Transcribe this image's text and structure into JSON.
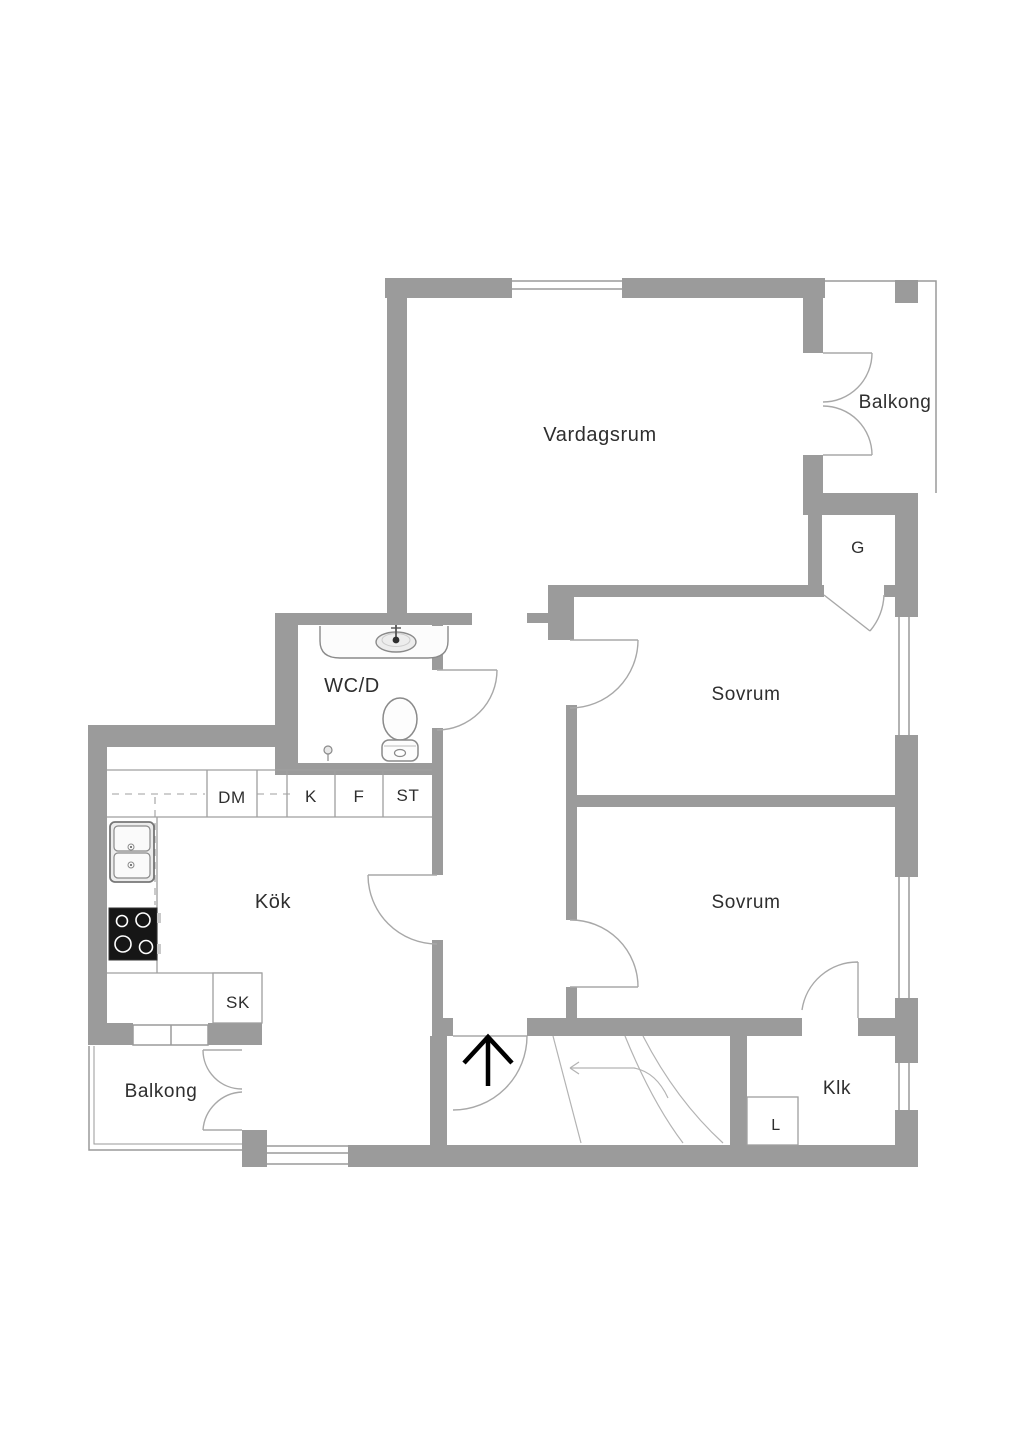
{
  "plan": {
    "rooms": {
      "living_room": "Vardagsrum",
      "balcony_top": "Balkong",
      "closet_g": "G",
      "bedroom_1": "Sovrum",
      "bathroom": "WC/D",
      "kitchen": "Kök",
      "bedroom_2": "Sovrum",
      "closet_sk": "SK",
      "balcony_bottom": "Balkong",
      "walk_in_closet": "Klk",
      "closet_l": "L"
    },
    "kitchen_units": {
      "dm": "DM",
      "k": "K",
      "f": "F",
      "st": "ST"
    },
    "colors": {
      "background": "#ffffff",
      "wall": "#9b9b9b",
      "window_line": "#9a9a9a",
      "door_line": "#a8a8a8",
      "counter_line": "#9f9f9f",
      "stair_line": "#b3b3b3",
      "fixture_line": "#8a8a8a",
      "fixture_fill": "#f2f2f2",
      "stove": "#161616",
      "entry_arrow": "#000000",
      "text": "#2e2e2e"
    },
    "icons": {
      "bathroom_sink": "bathroom-sink-icon",
      "toilet": "toilet-icon",
      "floor_drain": "floor-drain-icon",
      "kitchen_sink": "kitchen-sink-icon",
      "stove": "stove-icon",
      "entry_arrow": "stairs-up-arrow-icon",
      "staircase": "staircase-icon"
    }
  }
}
